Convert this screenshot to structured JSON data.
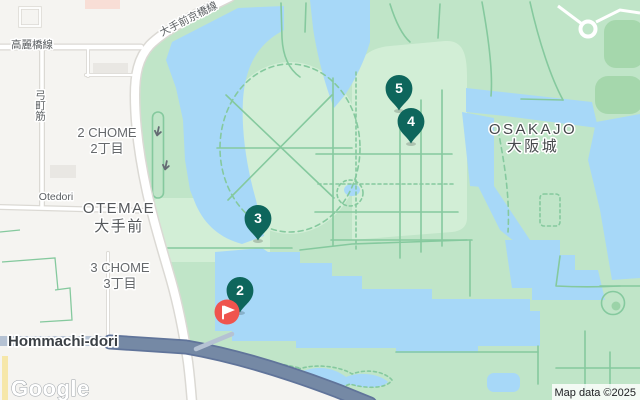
{
  "colors": {
    "water": "#a7d8f8",
    "park": "#c0e5c8",
    "park_inner": "#d2eed6",
    "trees": "#a5d7ac",
    "path": "#85c99e",
    "city": "#f5f4f1",
    "building": "#e9e7e3",
    "building_pink": "#f8ded6",
    "road_casing": "#dbd9d4",
    "road_fill": "#ffffff",
    "road_yellow": "#f6e7a9",
    "highway": "#7589a5",
    "highway_casing": "#60749a",
    "highway_light": "#b5c2d3",
    "marker_teal": "#0e665c",
    "flag_red": "#ef544e"
  },
  "labels": {
    "road_keihanshin": "大手前京橋線",
    "road_koraibashi": "高麗橋線",
    "road_yumimachi": "弓町筋",
    "road_otedori": "Otedori",
    "road_hommachi": "Hommachi-dori",
    "area_2chome": {
      "en": "2 CHOME",
      "ja": "2丁目"
    },
    "area_otemae": {
      "en": "OTEMAE",
      "ja": "大手前"
    },
    "area_3chome": {
      "en": "3 CHOME",
      "ja": "3丁目"
    },
    "area_osakajo": {
      "en": "OSAKAJO",
      "ja": "大阪城"
    }
  },
  "markers": {
    "pins": [
      {
        "number": "5"
      },
      {
        "number": "4"
      },
      {
        "number": "3"
      },
      {
        "number": "2"
      }
    ],
    "flag": {
      "icon": "flag"
    }
  },
  "attribution": {
    "logo": "Google",
    "map_data": "Map data ©2025"
  }
}
